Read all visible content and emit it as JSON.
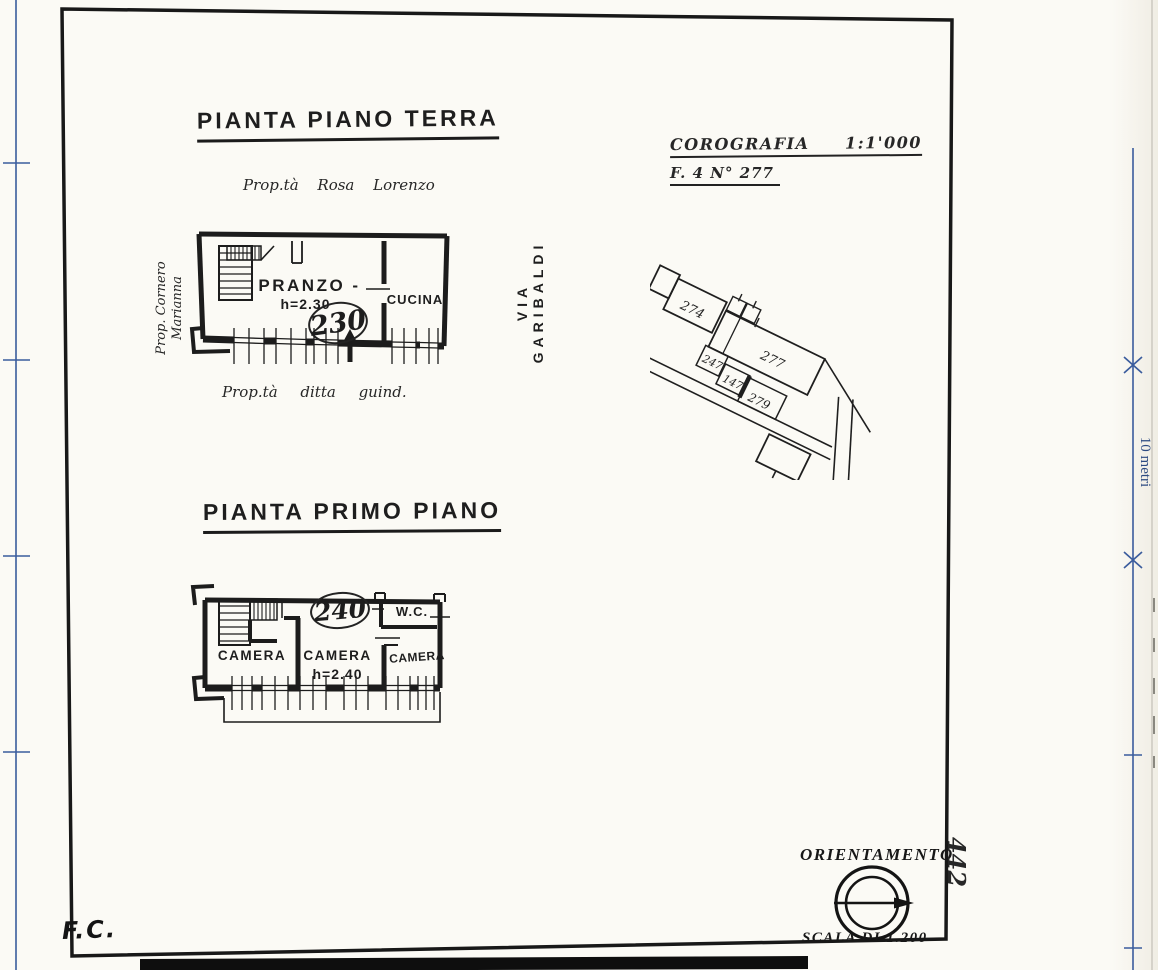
{
  "colors": {
    "ink": "#1c1c1c",
    "blue": "#3a5c9d",
    "paper": "#fbfaf5"
  },
  "titles": {
    "ground": "PIANTA PIANO TERRA",
    "first": "PIANTA PRIMO PIANO"
  },
  "ground_floor": {
    "owner_top": "Prop.tà  Rosa  Lorenzo",
    "owner_left_line1": "Prop.  Cornero",
    "owner_left_line2": "Marianna",
    "owner_bottom": "Prop.tà  ditta  guind.",
    "street": "VIA GARIBALDI",
    "pranzo": "PRANZO -",
    "pranzo_h": "h=2.30",
    "pranzo_note": "230",
    "cucina": "CUCINA"
  },
  "first_floor": {
    "note": "240",
    "wc": "W.C.",
    "camera1": "CAMERA",
    "camera2": "CAMERA",
    "camera2_h": "h=2.40",
    "camera3": "CAMERA"
  },
  "corografia": {
    "title": "COROGRAFIA",
    "scale": "1:1'000",
    "ref": "F. 4 N° 277",
    "parcels": {
      "p274": "274",
      "p277": "277",
      "p247": "247",
      "p147": "147",
      "p279": "279"
    }
  },
  "orientation": {
    "title": "ORIENTAMENTO",
    "scale": "SCALA DI 1.200"
  },
  "margins": {
    "initials": "F.C.",
    "side_number": "442",
    "ruler": "10 metri"
  }
}
